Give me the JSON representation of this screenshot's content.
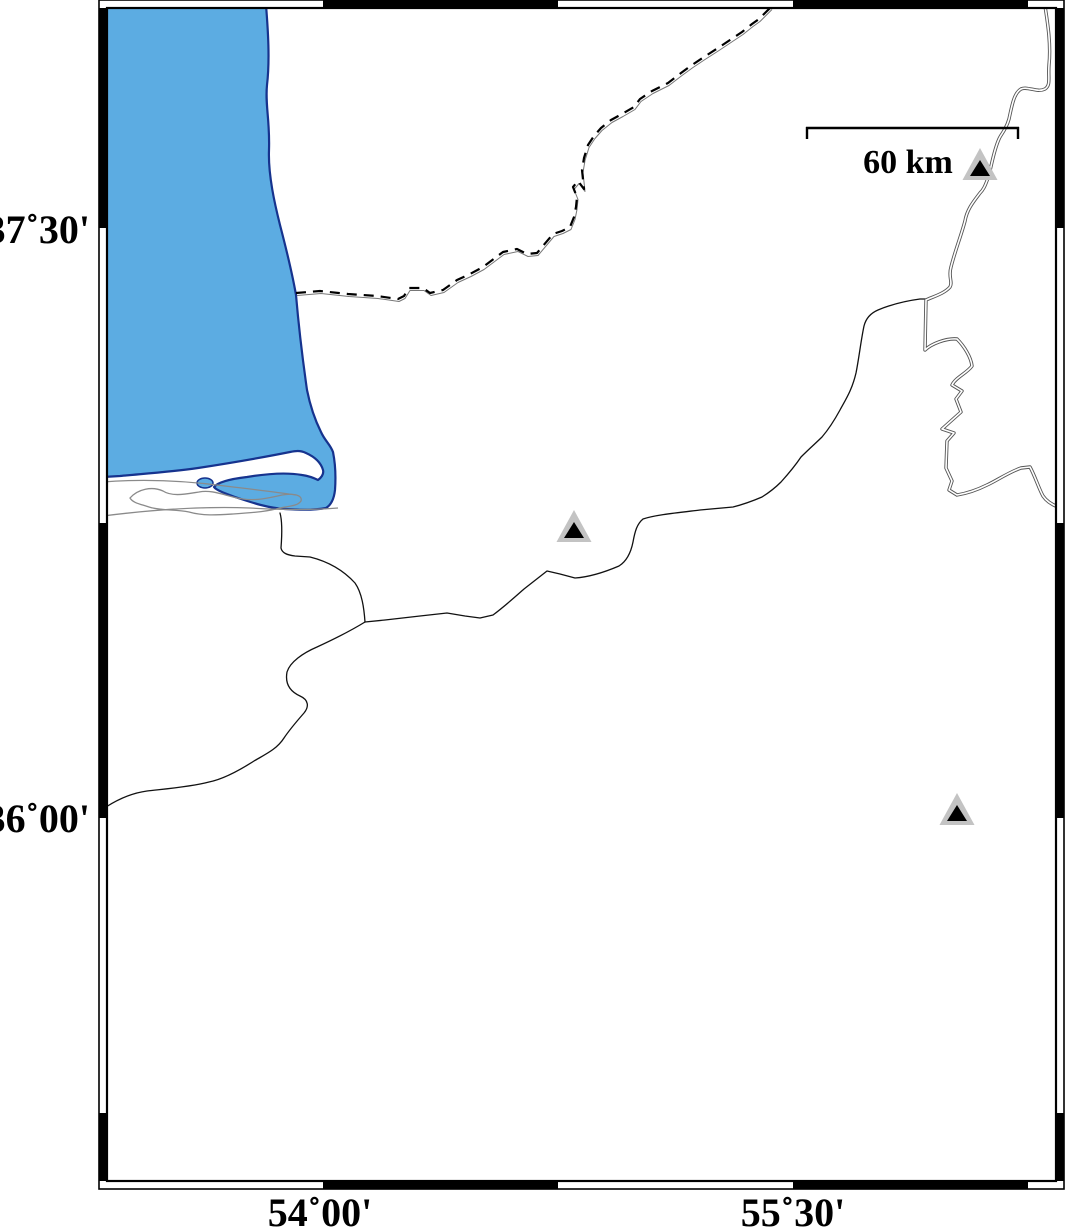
{
  "map": {
    "lat_labels": [
      {
        "text": "37˚30'"
      },
      {
        "text": "36˚00'"
      }
    ],
    "lon_labels": [
      {
        "text": "54˚00'"
      },
      {
        "text": "55˚30'"
      }
    ],
    "scale_bar": {
      "label": "60 km"
    },
    "stations": [
      {
        "x": 980,
        "y": 165
      },
      {
        "x": 574,
        "y": 527
      },
      {
        "x": 957,
        "y": 810
      }
    ],
    "colors": {
      "water_fill": "#5CACE2",
      "water_stroke": "#16338E",
      "land": "#FFFFFF",
      "coastline_grey": "#8A8A8A",
      "river": "#111111",
      "border": "#000000",
      "station_outer": "#C3C3C3",
      "station_inner": "#000000"
    }
  }
}
